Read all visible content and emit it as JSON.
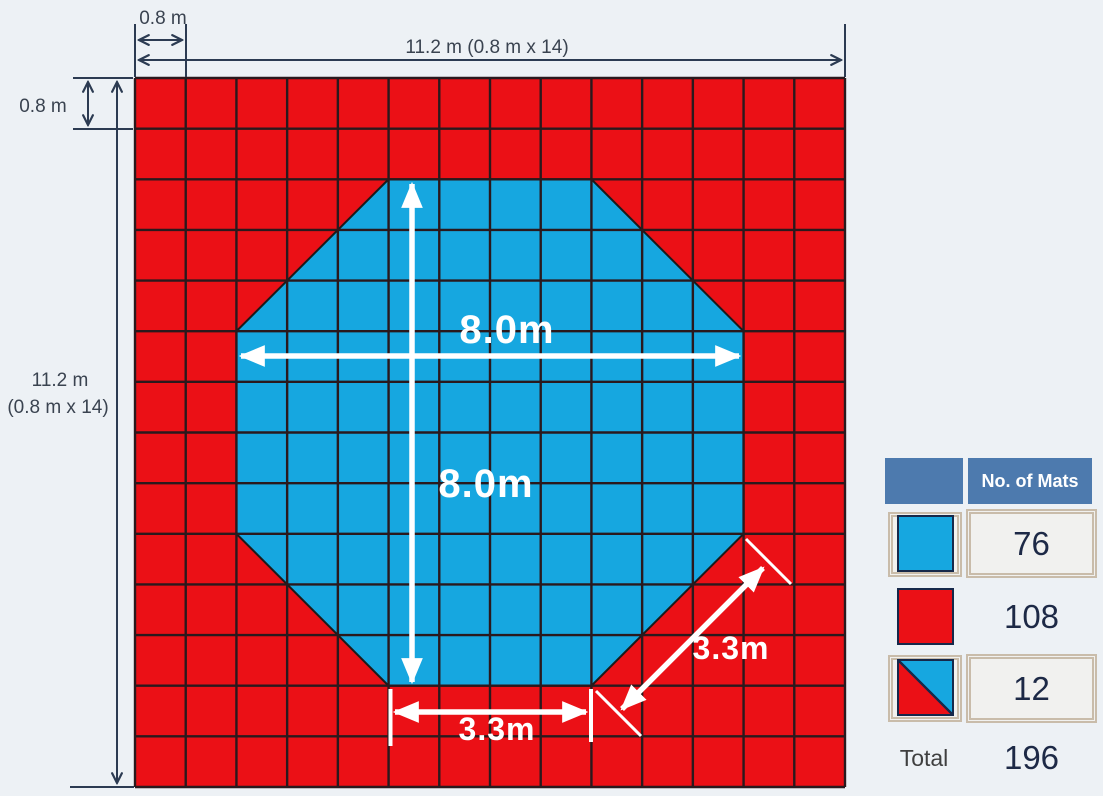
{
  "colors": {
    "bg": "#edf1f5",
    "red": "#eb1016",
    "blue": "#16a7e0",
    "grid_line": "#2a191d",
    "octagon_edge": "#1b1b1b",
    "dim_line": "#2c3b52",
    "dim_text": "#3a4350",
    "header_bg": "#4d7aae",
    "header_text": "#ffffff",
    "value_text": "#1d2946",
    "total_text": "#3f3f3f",
    "box_tan": "#c9bcaa",
    "swatch_border": "#16284a"
  },
  "diagram": {
    "grid": {
      "x": 135,
      "y": 78,
      "w": 710,
      "h": 709,
      "cols": 14,
      "rows": 14
    },
    "octagon_cells": [
      [
        5,
        2
      ],
      [
        9,
        2
      ],
      [
        12,
        5
      ],
      [
        12,
        9
      ],
      [
        9,
        12
      ],
      [
        5,
        12
      ],
      [
        2,
        9
      ],
      [
        2,
        5
      ]
    ],
    "dim": {
      "segments": [
        [
          135,
          24,
          135,
          77
        ],
        [
          186,
          24,
          186,
          77
        ],
        [
          845,
          24,
          845,
          77
        ],
        [
          73,
          78,
          133,
          78
        ],
        [
          73,
          129,
          133,
          129
        ],
        [
          70,
          787,
          134,
          787
        ]
      ],
      "arrows": [
        [
          139,
          40,
          182,
          40
        ],
        [
          139,
          60,
          841,
          60
        ],
        [
          88,
          82,
          88,
          125
        ],
        [
          117,
          82,
          117,
          783
        ]
      ]
    },
    "white": {
      "ticks": [
        [
          390.5,
          689,
          390.5,
          746,
          4
        ],
        [
          591,
          689,
          591,
          742,
          4
        ],
        [
          596,
          691,
          641,
          736,
          3
        ],
        [
          746,
          539,
          791,
          584,
          3
        ]
      ],
      "arrows": [
        [
          241,
          356,
          739,
          356
        ],
        [
          412,
          184,
          412,
          682
        ],
        [
          395,
          712,
          586,
          712
        ],
        [
          622,
          709,
          763,
          568
        ]
      ]
    },
    "labels": {
      "dim": [
        {
          "id": "label-cell-width-top",
          "text": "0.8 m",
          "x": 163,
          "y": 24
        },
        {
          "id": "label-total-width-top",
          "text": "11.2 m (0.8 m x 14)",
          "x": 487,
          "y": 53
        },
        {
          "id": "label-cell-height-left",
          "text": "0.8 m",
          "x": 43,
          "y": 112
        },
        {
          "id": "label-total-height-left-line1",
          "text": "11.2 m",
          "x": 60,
          "y": 386
        },
        {
          "id": "label-total-height-left-line2",
          "text": "(0.8 m x 14)",
          "x": 58,
          "y": 413
        }
      ],
      "measure": [
        {
          "id": "label-octagon-width",
          "text": "8.0m",
          "x": 507,
          "y": 343,
          "size": 40
        },
        {
          "id": "label-octagon-height",
          "text": "8.0m",
          "x": 486,
          "y": 497,
          "size": 40
        },
        {
          "id": "label-bottom-edge",
          "text": "3.3m",
          "x": 497,
          "y": 740,
          "size": 32
        },
        {
          "id": "label-diagonal-edge",
          "text": "3.3m",
          "x": 731,
          "y": 659,
          "size": 32
        }
      ]
    }
  },
  "legend": {
    "header": "No. of Mats",
    "rows": [
      {
        "swatch": "blue-mat",
        "value": "76"
      },
      {
        "swatch": "red-mat",
        "value": "108"
      },
      {
        "swatch": "half-mat",
        "value": "12"
      }
    ],
    "total_label": "Total",
    "total_value": "196"
  }
}
